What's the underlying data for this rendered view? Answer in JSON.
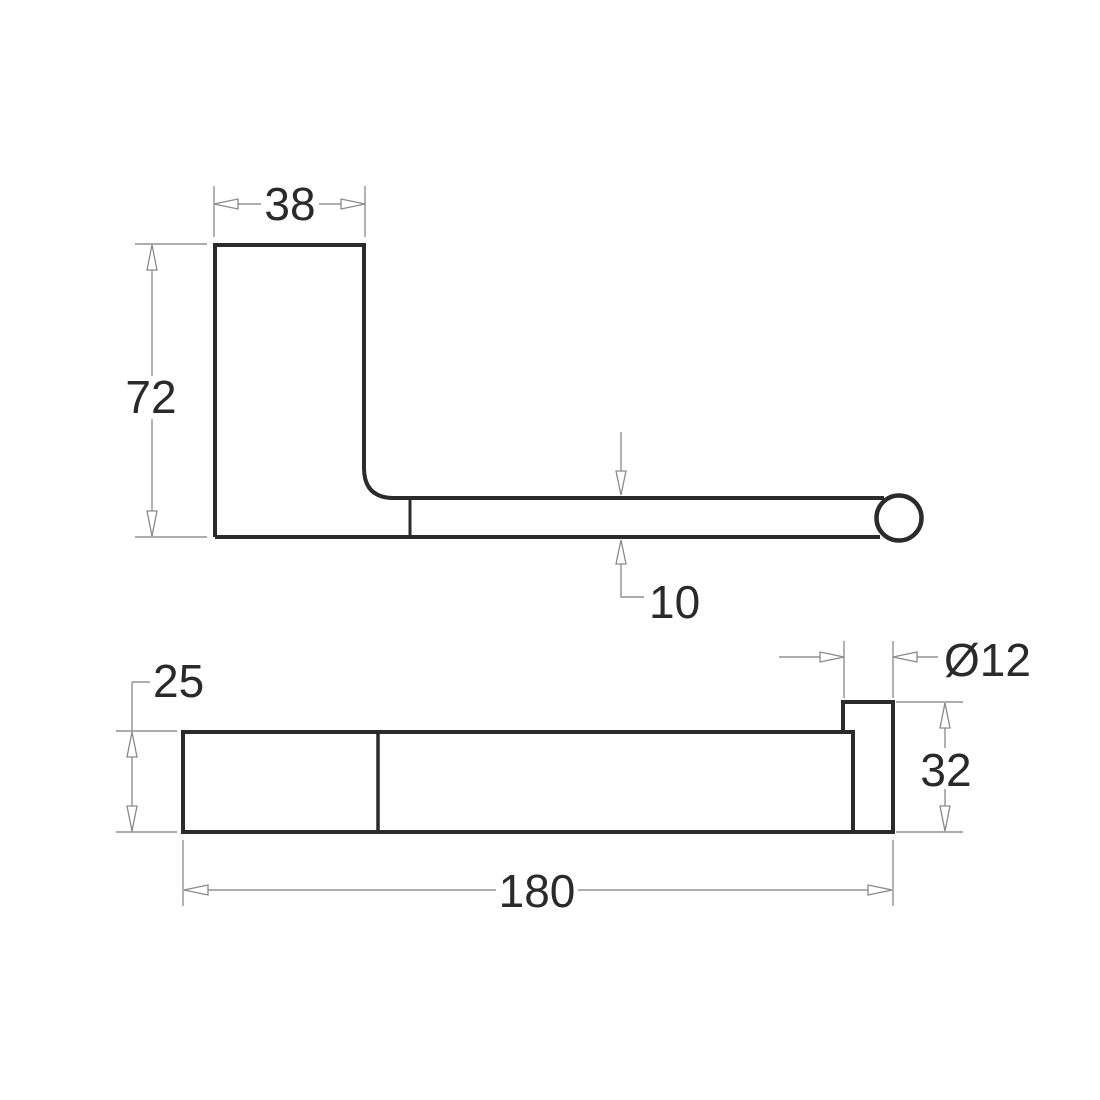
{
  "drawing": {
    "type": "technical-drawing",
    "subject": "wall-mounted roll holder / rail bracket, two orthographic views",
    "background_color": "#ffffff",
    "outline_color": "#2b2b2b",
    "dimension_color": "#929292",
    "text_color": "#2a2a2a",
    "views": {
      "side_view": {
        "dimensions": {
          "plate_width": {
            "label": "38",
            "value": 38
          },
          "plate_height": {
            "label": "72",
            "value": 72
          },
          "arm_thickness": {
            "label": "10",
            "value": 10
          }
        }
      },
      "plan_view": {
        "dimensions": {
          "bar_depth": {
            "label": "25",
            "value": 25
          },
          "overall_length": {
            "label": "180",
            "value": 180
          },
          "end_post_height": {
            "label": "32",
            "value": 32
          },
          "end_post_diameter": {
            "label": "Ø12",
            "value": 12
          }
        }
      }
    }
  }
}
